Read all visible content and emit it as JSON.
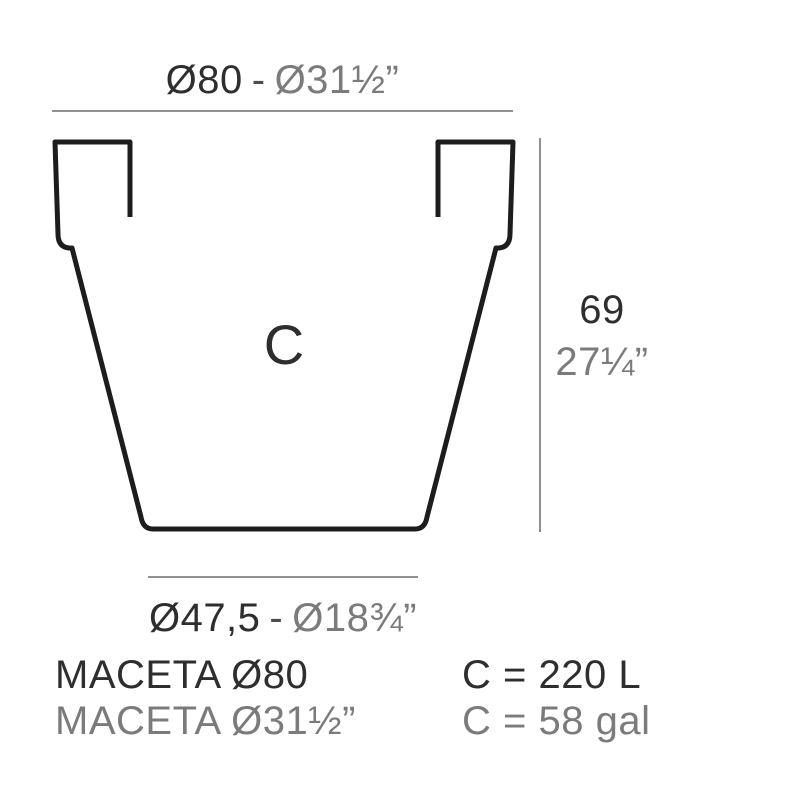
{
  "colors": {
    "outline_ink": "#1d1d1b",
    "dark_text": "#2e2e2e",
    "gray_text": "#7b7b7b",
    "dimension_line": "#919191",
    "background": "#ffffff"
  },
  "top_dimension": {
    "metric": "Ø80",
    "separator": "-",
    "imperial": "Ø31½”"
  },
  "height_dimension": {
    "metric": "69",
    "imperial": "27¼”"
  },
  "bottom_dimension": {
    "metric": "Ø47,5",
    "separator": "-",
    "imperial": "Ø18¾”"
  },
  "pot": {
    "capacity_letter": "C"
  },
  "product_labels": {
    "metric": "MACETA Ø80",
    "imperial": "MACETA Ø31½”"
  },
  "capacity_labels": {
    "liters": "C = 220 L",
    "gallons": "C = 58 gal"
  }
}
